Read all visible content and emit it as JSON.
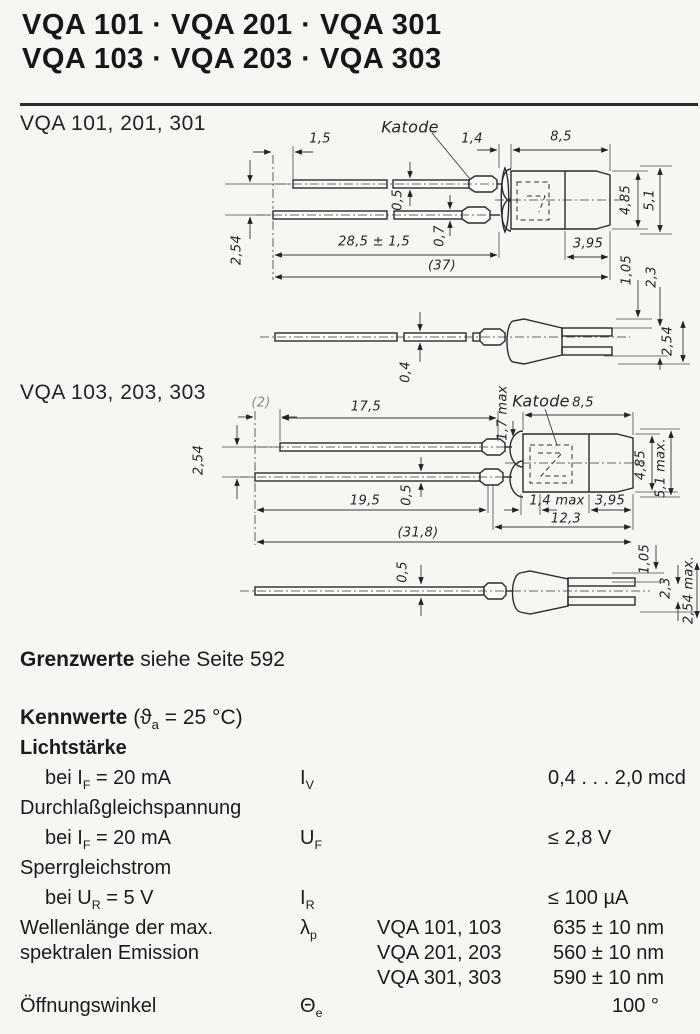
{
  "page": {
    "bg": "#f6f6f2",
    "ink": "#1b1b1b"
  },
  "header": {
    "line1": "VQA 101 · VQA 201 · VQA 301",
    "line2": "VQA 103 · VQA 203 · VQA 303"
  },
  "diagram1": {
    "title": "VQA 101, 201, 301",
    "labels": [
      "Katode",
      "1,5",
      "1,4",
      "8,5",
      "0,5",
      "0,7",
      "28,5 ± 1,5",
      "(37)",
      "2,54",
      "4,85",
      "5,1",
      "3,95",
      "1,05",
      "2,3",
      "0,4",
      "2,54"
    ]
  },
  "diagram2": {
    "title": "VQA 103, 203, 303",
    "labels": [
      "Katode",
      "(2)",
      "17,5",
      "1,7 max",
      "8,5",
      "2,54",
      "0,5",
      "19,5",
      "1,4 max",
      "3,95",
      "12,3",
      "(31,8)",
      "4,85",
      "5,1 max.",
      "0,5",
      "1,05",
      "2,3",
      "2,54 max."
    ]
  },
  "limits": {
    "bold": "Grenzwerte",
    "rest": " siehe Seite 592"
  },
  "kennwerte": {
    "bold": "Kennwerte",
    "cond_pre": "  (ϑ",
    "cond_sub": "a",
    "cond_post": " = 25 °C)"
  },
  "table": {
    "rows": [
      {
        "label": "Lichtstärke"
      },
      {
        "pre": "bei I",
        "sub": "F",
        "post": " = 20 mA",
        "sym": "I",
        "symsub": "V",
        "value": "0,4 . . . 2,0 mcd"
      },
      {
        "label": "Durchlaßgleichspannung"
      },
      {
        "pre": "bei I",
        "sub": "F",
        "post": " = 20 mA",
        "sym": "U",
        "symsub": "F",
        "value": "≤ 2,8 V"
      },
      {
        "label": "Sperrgleichstrom"
      },
      {
        "pre": "bei U",
        "sub": "R",
        "post": " = 5 V",
        "sym": "I",
        "symsub": "R",
        "value": "≤ 100 µA"
      },
      {
        "label1": "Wellenlänge der max.",
        "label2": "spektralen Emission",
        "sym": "λ",
        "symsub": "p",
        "entries": [
          {
            "variant": "VQA 101, 103",
            "value": "635 ± 10 nm"
          },
          {
            "variant": "VQA 201, 203",
            "value": "560 ± 10 nm"
          },
          {
            "variant": "VQA 301, 303",
            "value": "590 ± 10 nm"
          }
        ]
      },
      {
        "label": "Öffnungswinkel",
        "sym": "Θ",
        "symsub": "e",
        "value": "100 °"
      }
    ]
  }
}
